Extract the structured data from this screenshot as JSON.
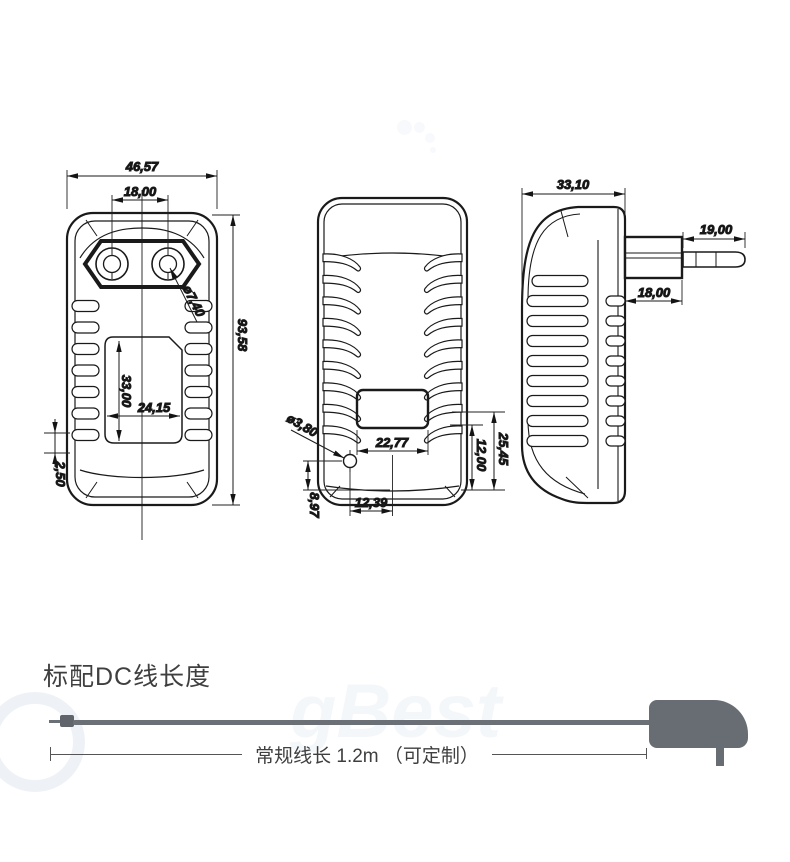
{
  "drawing": {
    "front": {
      "overall_width": "46,57",
      "pin_spacing": "18,00",
      "pin_hole_diameter": "ø7,40",
      "overall_height": "93,58",
      "recess_height": "33,00",
      "recess_width": "24,15",
      "vent_pitch": "2,50"
    },
    "back": {
      "hole_diameter": "ø3,80",
      "recess_width": "22,77",
      "recess_to_bottom": "25,45",
      "recess_height": "12,00",
      "hole_offset_x": "12,39",
      "hole_offset_y": "8,97"
    },
    "side": {
      "overall_depth": "33,10",
      "pin_length": "19,00",
      "plug_base_width": "18,00"
    }
  },
  "cable_section": {
    "title": "标配DC线长度",
    "length_label": "常规线长 1.2m （可定制）"
  },
  "colors": {
    "line": "#1a1a1a",
    "cable_gray": "#6b7076",
    "adapter_gray": "#686d73",
    "text_dark": "#3f3f3f"
  }
}
